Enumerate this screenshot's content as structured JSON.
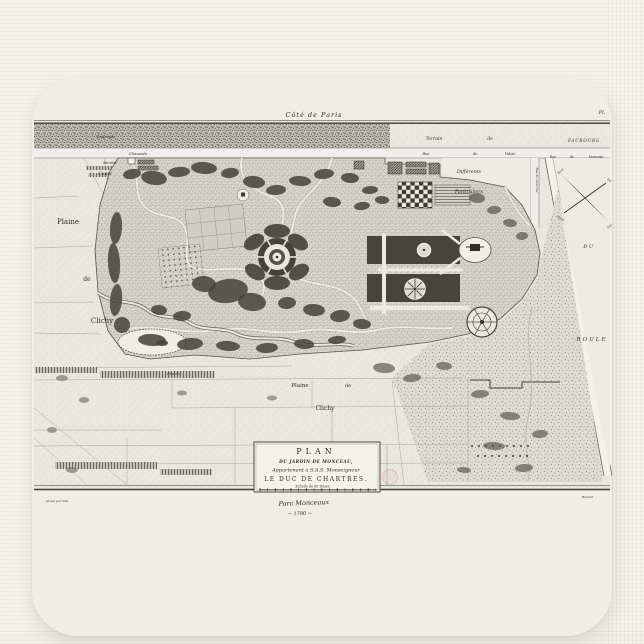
{
  "scene": {
    "product": "mousepad",
    "print_subject": "antique engraved garden plan"
  },
  "palette": {
    "page_bg": "#f3f1ec",
    "pad_surface": "#fbfaf8",
    "print_paper": "#efede8",
    "map_field": "#e9e7e1",
    "garden_tone": "#d7d4cb",
    "tree_ink": "#44423b",
    "line_ink": "#2f2d28",
    "handwriting_ink": "#a09e9a",
    "stamp_pink": "#c89090"
  },
  "map": {
    "cartouche": {
      "line1": "PLAN",
      "line2": "DU JARDIN DE MONCEAU,",
      "line3": "Appartenant à S.A.S. Monseigneur",
      "line4": "LE DUC DE CHARTRES.",
      "scale_note": "Echelle de 60 Toises."
    },
    "handwriting": {
      "title": "Parc Monceaux",
      "date": "~ 1780 ~"
    },
    "compass": {
      "n": "Nord",
      "s": "Sud",
      "e": "Est",
      "o": "Ouest"
    },
    "labels": [
      {
        "id": "label-cote-de-paris",
        "t": "Côté de Paris",
        "x": 282,
        "y": 39,
        "s": 6.5,
        "i": 1,
        "ls": 1
      },
      {
        "id": "label-plate-number",
        "t": "Pl.",
        "x": 570,
        "y": 36,
        "s": 5,
        "i": 1
      },
      {
        "id": "label-esplanade",
        "t": "Esplanade",
        "x": 74,
        "y": 60,
        "s": 3.6,
        "i": 1,
        "c": "#3c3a33"
      },
      {
        "id": "label-chaussee",
        "t": "Chaussée",
        "x": 106,
        "y": 77,
        "s": 3.8,
        "i": 1
      },
      {
        "id": "label-barriere",
        "t": "Barrière",
        "x": 78,
        "y": 86,
        "s": 3.2,
        "i": 1
      },
      {
        "id": "label-cours",
        "t": "Cours",
        "x": 73,
        "y": 97,
        "s": 4.5,
        "i": 1
      },
      {
        "id": "label-plaine-left",
        "t": "Plaine",
        "x": 36,
        "y": 146,
        "s": 7
      },
      {
        "id": "label-de-left",
        "t": "de",
        "x": 55,
        "y": 203,
        "s": 6
      },
      {
        "id": "label-clichy-left",
        "t": "Clichy",
        "x": 70,
        "y": 245,
        "s": 7
      },
      {
        "id": "label-terrain",
        "t": "Terrain",
        "x": 402,
        "y": 62,
        "s": 4.5,
        "i": 1
      },
      {
        "id": "label-terrain-de",
        "t": "de",
        "x": 458,
        "y": 62,
        "s": 4.5,
        "i": 1
      },
      {
        "id": "label-rue-valois-rue",
        "t": "Rue",
        "x": 394,
        "y": 77,
        "s": 3.5,
        "i": 1
      },
      {
        "id": "label-rue-valois-de",
        "t": "de",
        "x": 443,
        "y": 77,
        "s": 3.5,
        "i": 1
      },
      {
        "id": "label-rue-valois-valois",
        "t": "Valois",
        "x": 478,
        "y": 77,
        "s": 3.5,
        "i": 1
      },
      {
        "id": "label-faubourg",
        "t": "FAUBOURG",
        "x": 552,
        "y": 64,
        "s": 4.2,
        "i": 1,
        "ls": 0.8
      },
      {
        "id": "label-rue-monceau-rue",
        "t": "Rue",
        "x": 521,
        "y": 80,
        "s": 3.2,
        "i": 1
      },
      {
        "id": "label-rue-monceau-de",
        "t": "de",
        "x": 540,
        "y": 80,
        "s": 3.2,
        "i": 1
      },
      {
        "id": "label-rue-monceau-monceau",
        "t": "Monceau",
        "x": 564,
        "y": 80,
        "s": 3.2,
        "i": 1
      },
      {
        "id": "label-differents",
        "t": "Différents",
        "x": 437,
        "y": 95,
        "s": 4.8,
        "i": 1
      },
      {
        "id": "label-particuliers",
        "t": "Particuliers",
        "x": 437,
        "y": 115,
        "s": 4.8,
        "i": 1
      },
      {
        "id": "label-rue-de-chartres",
        "t": "Rue de Chartres",
        "x": 504,
        "y": 102,
        "s": 3,
        "i": 1,
        "r": 90
      },
      {
        "id": "label-du",
        "t": "DU",
        "x": 557,
        "y": 170,
        "s": 5,
        "i": 1,
        "ls": 1.5
      },
      {
        "id": "label-roule",
        "t": "ROULE",
        "x": 560,
        "y": 263,
        "s": 5.5,
        "i": 1,
        "ls": 2
      },
      {
        "id": "label-compass-nord",
        "t": "Nord",
        "x": 529,
        "y": 94,
        "s": 2.8,
        "i": 1,
        "r": -40
      },
      {
        "id": "label-compass-sud",
        "t": "Sud",
        "x": 578,
        "y": 149,
        "s": 2.8,
        "i": 1,
        "r": -40
      },
      {
        "id": "label-compass-est",
        "t": "Est",
        "x": 577,
        "y": 103,
        "s": 2.8,
        "i": 1,
        "r": 30
      },
      {
        "id": "label-compass-ouest",
        "t": "Ouest",
        "x": 528,
        "y": 141,
        "s": 2.8,
        "i": 1,
        "r": 30
      },
      {
        "id": "label-prairie",
        "t": "Prairie",
        "x": 142,
        "y": 297,
        "s": 4,
        "i": 1
      },
      {
        "id": "label-plaine-bottom",
        "t": "Plaine",
        "x": 268,
        "y": 309,
        "s": 5.5
      },
      {
        "id": "label-de-bottom",
        "t": "de",
        "x": 316,
        "y": 309,
        "s": 5
      },
      {
        "id": "label-clichy-bottom",
        "t": "Clichy",
        "x": 293,
        "y": 332,
        "s": 6
      },
      {
        "id": "cartouche-plan",
        "t": "PLAN",
        "x": 284,
        "y": 376,
        "s": 8,
        "ls": 4
      },
      {
        "id": "cartouche-du-jardin",
        "t": "DU JARDIN DE MONCEAU,",
        "x": 284,
        "y": 385,
        "s": 4.2,
        "i": 1,
        "b": 1,
        "ls": 0.5
      },
      {
        "id": "cartouche-appartenant",
        "t": "Appartenant à S.A.S. Monseigneur",
        "x": 284,
        "y": 393.5,
        "s": 5,
        "i": 1
      },
      {
        "id": "cartouche-duc-chartres",
        "t": "LE DUC DE CHARTRES.",
        "x": 284,
        "y": 403,
        "s": 6,
        "ls": 1.5
      },
      {
        "id": "cartouche-echelle",
        "t": "Echelle de 60 Toises.",
        "x": 281,
        "y": 409.5,
        "s": 3.3,
        "i": 1
      },
      {
        "id": "handwriting-title",
        "t": "Parc Monceaux",
        "x": 272,
        "y": 427,
        "s": 6.5,
        "i": 1,
        "c": "#a3a19c",
        "r": -2
      },
      {
        "id": "handwriting-date",
        "t": "~ 1780 ~",
        "x": 268,
        "y": 437,
        "s": 5,
        "i": 1,
        "c": "#aaa8a3",
        "r": -2
      },
      {
        "id": "credit-left",
        "t": "Gravé par Née.",
        "x": 14,
        "y": 424,
        "s": 3,
        "i": 1,
        "c": "#93918b",
        "anchor": "start"
      },
      {
        "id": "credit-right",
        "t": "Benard.",
        "x": 556,
        "y": 420,
        "s": 3,
        "i": 1,
        "c": "#93918b"
      }
    ]
  }
}
